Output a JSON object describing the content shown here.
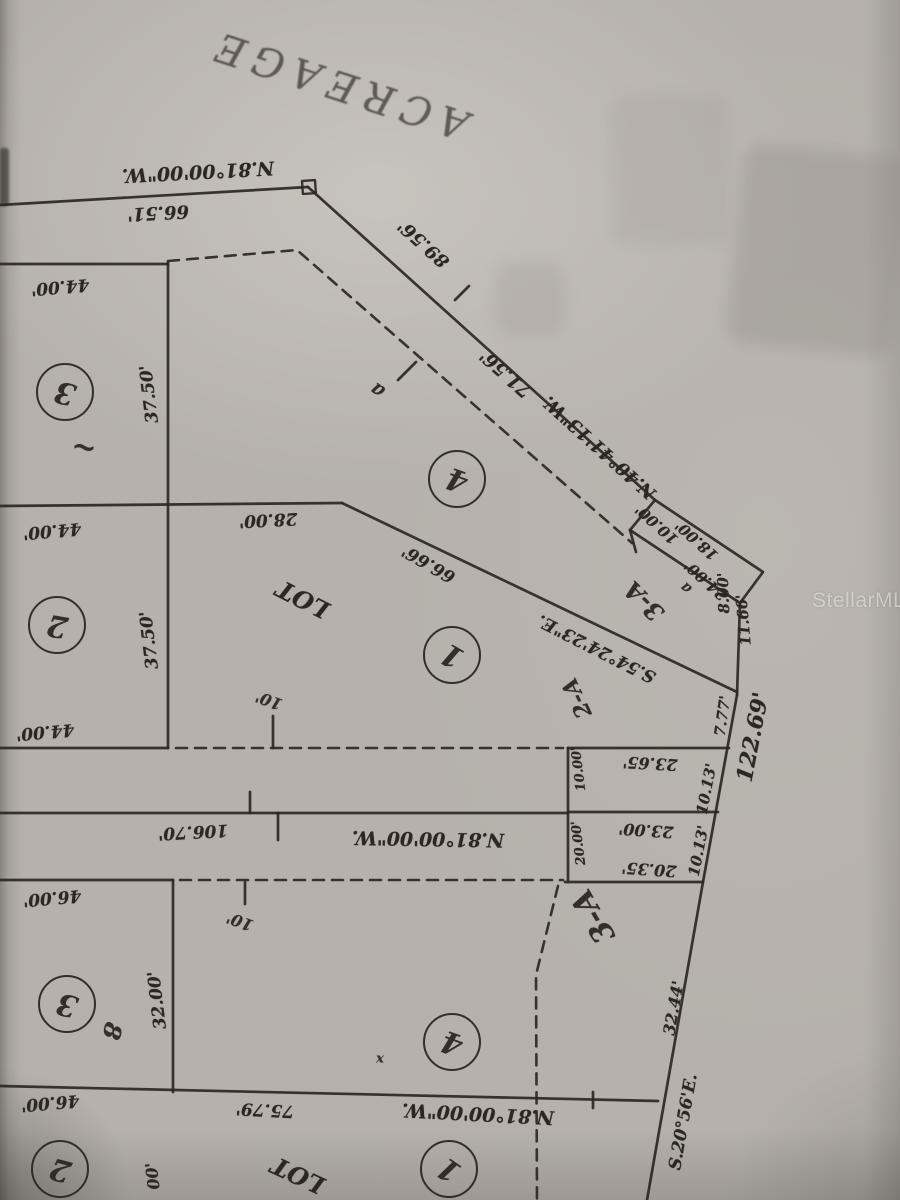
{
  "document_type": "scanned plat survey photo (page upside down)",
  "colors": {
    "paper": "#b6b1ac",
    "ink": "#2c2722",
    "watermark_text": "rgba(236,234,231,0.62)"
  },
  "watermark": {
    "text": "StellarMLS",
    "x": 858,
    "y": 600
  },
  "plat": {
    "labels": [
      {
        "t": "ACREAGE",
        "x": 338,
        "y": 84,
        "r": 198,
        "s": 40,
        "k": "street",
        "n": "street-name-label"
      },
      {
        "t": "N.81°00'00\"W.",
        "x": 198,
        "y": 171,
        "r": 177,
        "s": 19,
        "n": "bearing-label"
      },
      {
        "t": "66.51'",
        "x": 158,
        "y": 212,
        "r": 177,
        "s": 18,
        "n": "dimension-label"
      },
      {
        "t": "89.56'",
        "x": 424,
        "y": 243,
        "r": 222,
        "s": 18,
        "n": "dimension-label"
      },
      {
        "t": "71.56'",
        "x": 506,
        "y": 373,
        "r": 222,
        "s": 18,
        "n": "dimension-label"
      },
      {
        "t": "N.40°41'13\"W.",
        "x": 600,
        "y": 447,
        "r": 222,
        "s": 18,
        "n": "bearing-label"
      },
      {
        "t": "44.00'",
        "x": 60,
        "y": 286,
        "r": 175,
        "s": 17,
        "n": "dimension-label"
      },
      {
        "t": "37.50'",
        "x": 150,
        "y": 394,
        "r": 263,
        "s": 17,
        "n": "dimension-label"
      },
      {
        "t": "44.00'",
        "x": 52,
        "y": 530,
        "r": 175,
        "s": 17,
        "n": "dimension-label"
      },
      {
        "t": "37.50'",
        "x": 150,
        "y": 640,
        "r": 263,
        "s": 17,
        "n": "dimension-label"
      },
      {
        "t": "44.00'",
        "x": 45,
        "y": 731,
        "r": 175,
        "s": 17,
        "n": "dimension-label"
      },
      {
        "t": "28.00'",
        "x": 268,
        "y": 519,
        "r": 177,
        "s": 17,
        "n": "dimension-label"
      },
      {
        "t": "LOT",
        "x": 303,
        "y": 599,
        "r": 207,
        "s": 24,
        "n": "lot-text-label"
      },
      {
        "t": "66.66'",
        "x": 429,
        "y": 563,
        "r": 210,
        "s": 17,
        "n": "dimension-label"
      },
      {
        "t": "S.54°24'23\"E.",
        "x": 597,
        "y": 648,
        "r": 207,
        "s": 17,
        "n": "bearing-label"
      },
      {
        "t": "10.00'",
        "x": 657,
        "y": 524,
        "r": 222,
        "s": 15,
        "n": "dimension-label"
      },
      {
        "t": "18.00'",
        "x": 697,
        "y": 540,
        "r": 222,
        "s": 15,
        "n": "dimension-label"
      },
      {
        "t": "24.00'",
        "x": 706,
        "y": 580,
        "r": 222,
        "s": 15,
        "n": "dimension-label"
      },
      {
        "t": "a",
        "x": 686,
        "y": 588,
        "r": 222,
        "s": 15,
        "k": "hand",
        "n": "handwritten-note"
      },
      {
        "t": "8.00'",
        "x": 724,
        "y": 593,
        "r": 268,
        "s": 15,
        "n": "dimension-label"
      },
      {
        "t": "11.66'",
        "x": 744,
        "y": 620,
        "r": 265,
        "s": 15,
        "n": "dimension-label"
      },
      {
        "t": "7.77'",
        "x": 723,
        "y": 716,
        "r": 278,
        "s": 15,
        "n": "dimension-label"
      },
      {
        "t": "122.69'",
        "x": 753,
        "y": 737,
        "r": 281,
        "s": 22,
        "n": "dimension-label"
      },
      {
        "t": "3-A",
        "x": 644,
        "y": 601,
        "r": 225,
        "s": 24,
        "k": "hand",
        "n": "handwritten-parcel-label"
      },
      {
        "t": "2-A",
        "x": 577,
        "y": 698,
        "r": 245,
        "s": 22,
        "k": "hand",
        "n": "handwritten-parcel-label"
      },
      {
        "t": "23.65'",
        "x": 650,
        "y": 763,
        "r": 183,
        "s": 16,
        "n": "dimension-label"
      },
      {
        "t": "10.13'",
        "x": 707,
        "y": 789,
        "r": 281,
        "s": 15,
        "n": "dimension-label"
      },
      {
        "t": "23.00'",
        "x": 646,
        "y": 830,
        "r": 184,
        "s": 16,
        "n": "dimension-label"
      },
      {
        "t": "20.35'",
        "x": 649,
        "y": 869,
        "r": 184,
        "s": 16,
        "n": "dimension-label"
      },
      {
        "t": "10.13'",
        "x": 699,
        "y": 851,
        "r": 281,
        "s": 15,
        "n": "dimension-label"
      },
      {
        "t": "10.00'",
        "x": 579,
        "y": 769,
        "r": 263,
        "s": 13,
        "n": "dimension-label"
      },
      {
        "t": "20.00'",
        "x": 579,
        "y": 843,
        "r": 263,
        "s": 13,
        "n": "dimension-label"
      },
      {
        "t": "10'",
        "x": 269,
        "y": 700,
        "r": 200,
        "s": 16,
        "k": "hand",
        "n": "handwritten-note"
      },
      {
        "t": "106.70'",
        "x": 193,
        "y": 831,
        "r": 177,
        "s": 17,
        "n": "dimension-label"
      },
      {
        "t": "N.81°00'00\"W.",
        "x": 428,
        "y": 838,
        "r": 181,
        "s": 19,
        "n": "bearing-label"
      },
      {
        "t": "46.00'",
        "x": 52,
        "y": 897,
        "r": 175,
        "s": 17,
        "n": "dimension-label"
      },
      {
        "t": "32.00'",
        "x": 158,
        "y": 1000,
        "r": 263,
        "s": 17,
        "n": "dimension-label"
      },
      {
        "t": "10'",
        "x": 240,
        "y": 921,
        "r": 200,
        "s": 16,
        "k": "hand",
        "n": "handwritten-note"
      },
      {
        "t": "3-A",
        "x": 594,
        "y": 916,
        "r": 240,
        "s": 30,
        "k": "hand",
        "n": "handwritten-parcel-label"
      },
      {
        "t": "32.44'",
        "x": 674,
        "y": 1008,
        "r": 280,
        "s": 16,
        "n": "dimension-label"
      },
      {
        "t": "S.20°56'E.",
        "x": 684,
        "y": 1122,
        "r": 280,
        "s": 17,
        "n": "bearing-label"
      },
      {
        "t": "46.00'",
        "x": 50,
        "y": 1102,
        "r": 175,
        "s": 17,
        "n": "dimension-label"
      },
      {
        "t": "75.79'",
        "x": 265,
        "y": 1109,
        "r": 183,
        "s": 17,
        "n": "dimension-label"
      },
      {
        "t": "N.81°00'00\"W.",
        "x": 478,
        "y": 1113,
        "r": 183,
        "s": 19,
        "n": "bearing-label"
      },
      {
        "t": "LOT",
        "x": 298,
        "y": 1175,
        "r": 205,
        "s": 24,
        "n": "lot-text-label"
      },
      {
        "t": "00'",
        "x": 153,
        "y": 1176,
        "r": 263,
        "s": 16,
        "n": "dimension-label"
      },
      {
        "t": "~",
        "x": 84,
        "y": 447,
        "r": 190,
        "s": 30,
        "k": "hand",
        "n": "handwritten-note"
      },
      {
        "t": "8",
        "x": 112,
        "y": 1031,
        "r": 105,
        "s": 24,
        "k": "hand",
        "n": "handwritten-note"
      },
      {
        "t": "x",
        "x": 380,
        "y": 1059,
        "r": 0,
        "s": 13,
        "k": "hand",
        "n": "handwritten-note"
      },
      {
        "t": "a",
        "x": 377,
        "y": 391,
        "r": 215,
        "s": 20,
        "k": "hand",
        "n": "handwritten-note"
      }
    ],
    "lot_circles": [
      {
        "n": "3",
        "x": 63,
        "y": 390,
        "r": 195
      },
      {
        "n": "2",
        "x": 55,
        "y": 623,
        "r": 190
      },
      {
        "n": "4",
        "x": 455,
        "y": 477,
        "r": 200
      },
      {
        "n": "1",
        "x": 450,
        "y": 653,
        "r": 210
      },
      {
        "n": "3",
        "x": 65,
        "y": 1002,
        "r": 195
      },
      {
        "n": "4",
        "x": 450,
        "y": 1040,
        "r": 200
      },
      {
        "n": "1",
        "x": 447,
        "y": 1167,
        "r": 215
      },
      {
        "n": "2",
        "x": 58,
        "y": 1167,
        "r": 195
      }
    ],
    "geometry": {
      "solid": [
        [
          [
            0,
            205
          ],
          [
            308,
            187
          ]
        ],
        [
          [
            308,
            187
          ],
          [
            655,
            500
          ]
        ],
        [
          [
            655,
            500
          ],
          [
            763,
            572
          ],
          [
            740,
            603
          ],
          [
            630,
            530
          ],
          [
            655,
            500
          ]
        ],
        [
          [
            740,
            603
          ],
          [
            737,
            695
          ]
        ],
        [
          [
            630,
            530
          ],
          [
            636,
            552
          ]
        ],
        [
          [
            342,
            503
          ],
          [
            737,
            692
          ]
        ],
        [
          [
            0,
            506
          ],
          [
            342,
            503
          ]
        ],
        [
          [
            0,
            264
          ],
          [
            168,
            264
          ]
        ],
        [
          [
            168,
            262
          ],
          [
            168,
            748
          ]
        ],
        [
          [
            0,
            748
          ],
          [
            168,
            748
          ]
        ],
        [
          [
            0,
            813
          ],
          [
            568,
            813
          ]
        ],
        [
          [
            0,
            880
          ],
          [
            173,
            880
          ]
        ],
        [
          [
            173,
            880
          ],
          [
            173,
            1092
          ]
        ],
        [
          [
            0,
            1086
          ],
          [
            658,
            1101
          ]
        ],
        [
          [
            568,
            748
          ],
          [
            729,
            748
          ]
        ],
        [
          [
            568,
            748
          ],
          [
            568,
            882
          ]
        ],
        [
          [
            568,
            812
          ],
          [
            718,
            812
          ]
        ],
        [
          [
            565,
            882
          ],
          [
            703,
            882
          ]
        ],
        [
          [
            737,
            695
          ],
          [
            703,
            882
          ],
          [
            647,
            1200
          ]
        ]
      ],
      "dashed": [
        [
          [
            168,
            261
          ],
          [
            297,
            250
          ],
          [
            632,
            543
          ]
        ],
        [
          [
            180,
            880
          ],
          [
            563,
            880
          ]
        ],
        [
          [
            176,
            748
          ],
          [
            563,
            748
          ]
        ],
        [
          [
            558,
            886
          ],
          [
            536,
            975
          ],
          [
            537,
            1200
          ]
        ]
      ],
      "ticks": [
        [
          [
            455,
            300
          ],
          [
            469,
            286
          ]
        ],
        [
          [
            250,
            792
          ],
          [
            250,
            813
          ]
        ],
        [
          [
            278,
            813
          ],
          [
            278,
            840
          ]
        ],
        [
          [
            273,
            716
          ],
          [
            273,
            748
          ]
        ],
        [
          [
            245,
            882
          ],
          [
            245,
            904
          ]
        ],
        [
          [
            593,
            1092
          ],
          [
            593,
            1108
          ]
        ],
        [
          [
            398,
            380
          ],
          [
            416,
            362
          ]
        ]
      ],
      "marker_square": {
        "x": 302,
        "y": 181,
        "size": 13,
        "rot": -4
      }
    }
  }
}
